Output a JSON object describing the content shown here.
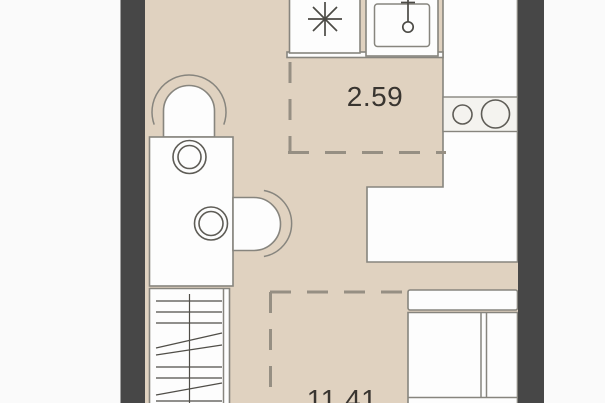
{
  "plan": {
    "type": "studio-apartment-floor-plan",
    "zones": [
      {
        "name": "kitchen-zone",
        "area": "2.59"
      },
      {
        "name": "living-zone",
        "area": "11.41"
      }
    ],
    "fixtures": [
      "fridge",
      "kitchen-sink",
      "hob",
      "washbasin",
      "bathroom-counter",
      "toilet",
      "wardrobe",
      "bed"
    ],
    "colors": {
      "background": "#fafafa",
      "wall": "#474747",
      "floor": "#e0d2c0",
      "fixture-fill": "#fdfdfd",
      "fixture-stroke": "#87857e",
      "dash": "#968f83",
      "hatch": "#504e48",
      "label-text": "#393530"
    }
  }
}
